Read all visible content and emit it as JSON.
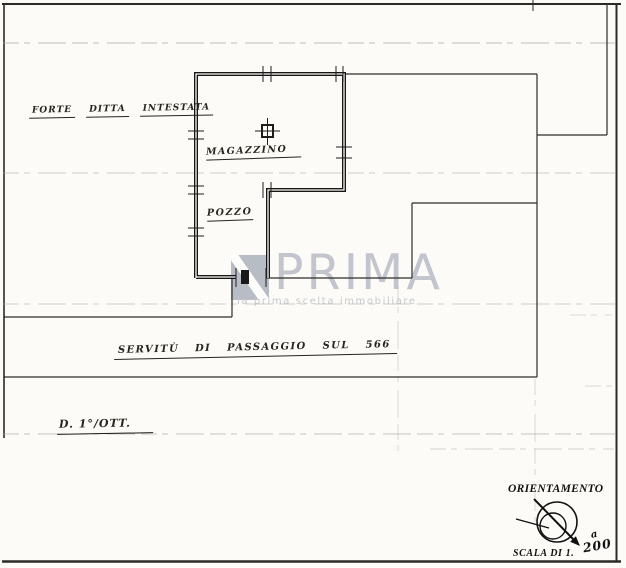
{
  "plan": {
    "owner_note": {
      "words": [
        "FORTE",
        "DITTA",
        "INTESTATA"
      ]
    },
    "rooms": {
      "room1": "MAGAZZINO",
      "room2": "POZZO"
    },
    "easement_note": "SERVITÙ DI PASSAGGIO SUL 566",
    "floor_note": "D. 1°/OTT.",
    "orientation": {
      "title": "ORIENTAMENTO",
      "scale_label": "SCALA DI 1.",
      "scale_fraction_top": "a",
      "scale_fraction_bottom": "200"
    },
    "watermark": {
      "brand": "PRIMA",
      "tagline": "la prima scelta immobiliare"
    },
    "colors": {
      "ink": "#1c1c1c",
      "paper": "#fcfbf7",
      "watermark_grey": "#c2c5cd"
    }
  }
}
